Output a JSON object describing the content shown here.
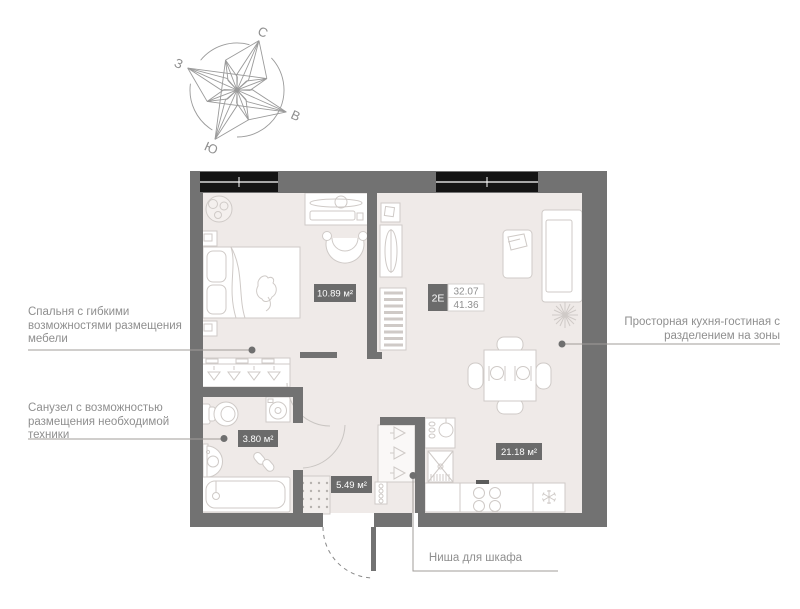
{
  "compass": {
    "north": "С",
    "east": "В",
    "south": "Ю",
    "west": "З"
  },
  "plan": {
    "unit_badge": {
      "type": "2Е",
      "area_living": "32.07",
      "area_total": "41.36"
    },
    "room_labels": {
      "bedroom": "10.89 м²",
      "bathroom": "3.80 м²",
      "hallway": "5.49 м²",
      "kitchen_living": "21.18 м²"
    },
    "colors": {
      "wall": "#727272",
      "floor": "#efeae8",
      "window": "#141414",
      "furniture_stroke": "#cfcac7",
      "label_bg": "#6b6b6b",
      "label_text": "#ffffff",
      "annotation_text": "#8f8f8f",
      "leader_line": "#a09c99"
    }
  },
  "annotations": {
    "bedroom": {
      "line1": "Спальня с гибкими",
      "line2": "возможностями размещения",
      "line3": "мебели"
    },
    "bathroom": {
      "line1": "Санузел с возможностью",
      "line2": "размещения необходимой",
      "line3": "техники"
    },
    "kitchen": {
      "line1": "Просторная кухня-гостиная с",
      "line2": "разделением на зоны"
    },
    "niche": {
      "line1": "Ниша для шкафа"
    }
  }
}
